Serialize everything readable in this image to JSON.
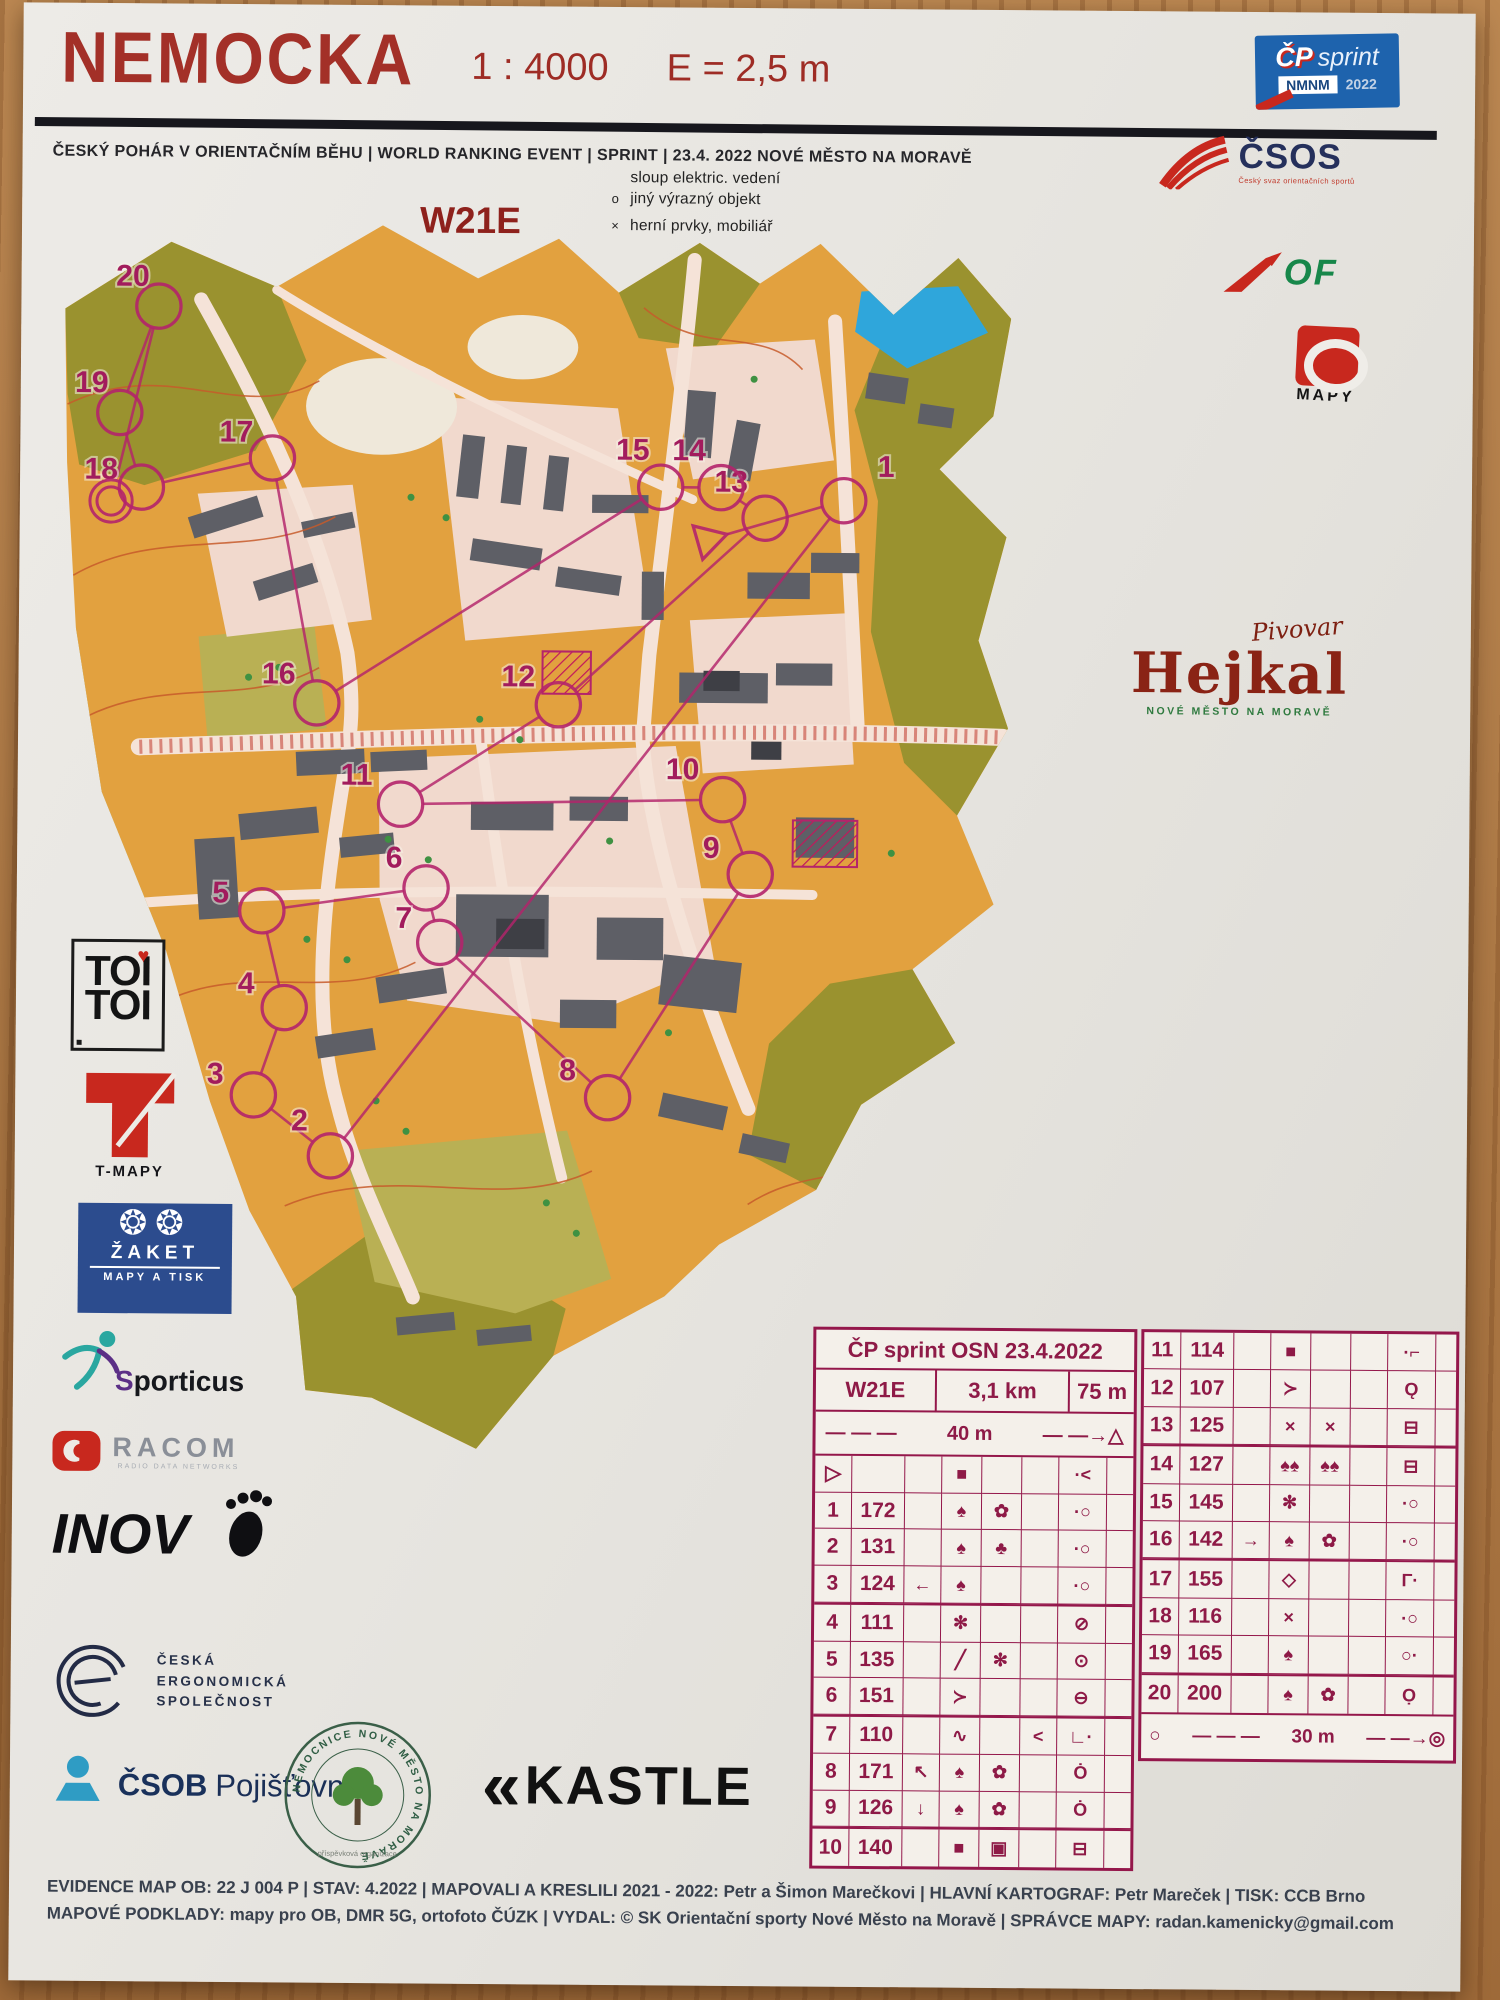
{
  "header": {
    "title": "NEMOCKA",
    "scale": "1 : 4000",
    "equidistance": "E = 2,5 m",
    "info_line": "ČESKÝ POHÁR V ORIENTAČNÍM BĚHU   |   WORLD RANKING EVENT   |   SPRINT   |   23.4. 2022 NOVÉ MĚSTO NA MORAVĚ"
  },
  "badge": {
    "cp": "ČP",
    "sprint": "sprint",
    "nmnm": "NMNM",
    "year": "2022"
  },
  "legend": {
    "items": [
      {
        "symbol": "",
        "label": "sloup elektric. vedení"
      },
      {
        "symbol": "o",
        "label": "jiný výrazný objekt"
      },
      {
        "symbol": "×",
        "label": "herní prvky, mobiliář"
      }
    ]
  },
  "class_label": "W21E",
  "logos": {
    "csos": {
      "name": "ČSOS",
      "tagline": "Český svaz orientačních sportů"
    },
    "iof": {
      "name": "OF"
    },
    "mapy": {
      "name": "MAPY"
    },
    "hejkal": {
      "script": "Pivovar",
      "name": "Hejkal",
      "sub": "NOVÉ MĚSTO NA MORAVĚ"
    },
    "toitoi": {
      "line1": "TOI",
      "line2": "TOI",
      "heart": "♥"
    },
    "tmapy": {
      "label": "T-MAPY"
    },
    "zaket": {
      "suns": "❂❂",
      "name": "ŽAKET",
      "sub": "MAPY A TISK"
    },
    "sporticus": {
      "initial": "S",
      "rest": "porticus"
    },
    "racom": {
      "name": "RACOM",
      "sub": "RADIO DATA NETWORKS"
    },
    "inov": {
      "name": "INOV"
    },
    "ergo": {
      "line1": "ČESKÁ",
      "line2": "ERGONOMICKÁ",
      "line3": "SPOLEČNOST"
    },
    "csob": {
      "name": "ČSOB",
      "sub": "Pojišťovna"
    },
    "hospital": {
      "ring": "NEMOCNICE NOVÉ MĚSTO NA MORAVĚ",
      "sub": "příspěvková organizace"
    },
    "kastle": {
      "chevrons": "«",
      "name": "KASTLE"
    }
  },
  "descriptions": {
    "title": "ČP sprint OSN 23.4.2022",
    "class": "W21E",
    "length": "3,1 km",
    "climb": "75 m",
    "start_distance": "40 m",
    "finish_distance": "30 m",
    "dashes": "— — —",
    "arrow_start": "— —→△",
    "arrow_finish": "— —→◎",
    "finish_pre": "○",
    "left_rows": [
      {
        "c": [
          "▷",
          "",
          "",
          "■",
          "",
          "",
          "·<",
          ""
        ],
        "t": false
      },
      {
        "c": [
          "1",
          "172",
          "",
          "♠",
          "✿",
          "",
          "·○",
          ""
        ],
        "t": false
      },
      {
        "c": [
          "2",
          "131",
          "",
          "♠",
          "♣",
          "",
          "·○",
          ""
        ],
        "t": false
      },
      {
        "c": [
          "3",
          "124",
          "←",
          "♠",
          "",
          "",
          "·○",
          ""
        ],
        "t": false
      },
      {
        "c": [
          "4",
          "111",
          "",
          "✻",
          "",
          "",
          "⊘",
          ""
        ],
        "t": true
      },
      {
        "c": [
          "5",
          "135",
          "",
          "╱",
          "✻",
          "",
          "⊙",
          ""
        ],
        "t": false
      },
      {
        "c": [
          "6",
          "151",
          "",
          "≻",
          "",
          "",
          "⊖",
          ""
        ],
        "t": false
      },
      {
        "c": [
          "7",
          "110",
          "",
          "∿",
          "",
          "<",
          "∟·",
          ""
        ],
        "t": true
      },
      {
        "c": [
          "8",
          "171",
          "↖",
          "♠",
          "✿",
          "",
          "Ȯ",
          ""
        ],
        "t": false
      },
      {
        "c": [
          "9",
          "126",
          "↓",
          "♠",
          "✿",
          "",
          "Ȯ",
          ""
        ],
        "t": false
      },
      {
        "c": [
          "10",
          "140",
          "",
          "■",
          "▣",
          "",
          "⊟",
          ""
        ],
        "t": true
      }
    ],
    "right_rows": [
      {
        "c": [
          "11",
          "114",
          "",
          "■",
          "",
          "",
          "·⌐",
          ""
        ],
        "t": false
      },
      {
        "c": [
          "12",
          "107",
          "",
          "≻",
          "",
          "",
          "Ǫ",
          ""
        ],
        "t": false
      },
      {
        "c": [
          "13",
          "125",
          "",
          "×",
          "×",
          "",
          "⊟",
          ""
        ],
        "t": false
      },
      {
        "c": [
          "14",
          "127",
          "",
          "♠♠",
          "♠♠",
          "",
          "⊟",
          ""
        ],
        "t": true
      },
      {
        "c": [
          "15",
          "145",
          "",
          "✻",
          "",
          "",
          "·○",
          ""
        ],
        "t": false
      },
      {
        "c": [
          "16",
          "142",
          "→",
          "♠",
          "✿",
          "",
          "·○",
          ""
        ],
        "t": false
      },
      {
        "c": [
          "17",
          "155",
          "",
          "◇",
          "",
          "",
          "Γ·",
          ""
        ],
        "t": true
      },
      {
        "c": [
          "18",
          "116",
          "",
          "×",
          "",
          "",
          "·○",
          ""
        ],
        "t": false
      },
      {
        "c": [
          "19",
          "165",
          "",
          "♠",
          "",
          "",
          "○·",
          ""
        ],
        "t": false
      },
      {
        "c": [
          "20",
          "200",
          "",
          "♠",
          "✿",
          "",
          "Ọ",
          ""
        ],
        "t": true
      }
    ]
  },
  "course": {
    "color": "#B4246B",
    "label_color": "#A21C5D",
    "start": {
      "x": 655,
      "y": 340
    },
    "finish": {
      "x": 62,
      "y": 306
    },
    "controls": [
      {
        "n": "1",
        "cx": 790,
        "cy": 300,
        "lx": 832,
        "ly": 276
      },
      {
        "n": "2",
        "cx": 285,
        "cy": 955,
        "lx": 254,
        "ly": 930
      },
      {
        "n": "3",
        "cx": 208,
        "cy": 895,
        "lx": 170,
        "ly": 884
      },
      {
        "n": "4",
        "cx": 238,
        "cy": 808,
        "lx": 200,
        "ly": 794
      },
      {
        "n": "5",
        "cx": 215,
        "cy": 712,
        "lx": 174,
        "ly": 704
      },
      {
        "n": "6",
        "cx": 378,
        "cy": 688,
        "lx": 346,
        "ly": 668
      },
      {
        "n": "7",
        "cx": 392,
        "cy": 742,
        "lx": 356,
        "ly": 728
      },
      {
        "n": "8",
        "cx": 560,
        "cy": 895,
        "lx": 520,
        "ly": 878
      },
      {
        "n": "9",
        "cx": 700,
        "cy": 672,
        "lx": 661,
        "ly": 656
      },
      {
        "n": "10",
        "cx": 672,
        "cy": 598,
        "lx": 632,
        "ly": 578
      },
      {
        "n": "11",
        "cx": 352,
        "cy": 605,
        "lx": 308,
        "ly": 586
      },
      {
        "n": "12",
        "cx": 508,
        "cy": 505,
        "lx": 468,
        "ly": 487
      },
      {
        "n": "13",
        "cx": 712,
        "cy": 318,
        "lx": 678,
        "ly": 292
      },
      {
        "n": "14",
        "cx": 668,
        "cy": 288,
        "lx": 636,
        "ly": 261
      },
      {
        "n": "15",
        "cx": 608,
        "cy": 288,
        "lx": 580,
        "ly": 261
      },
      {
        "n": "16",
        "cx": 268,
        "cy": 505,
        "lx": 230,
        "ly": 486
      },
      {
        "n": "17",
        "cx": 222,
        "cy": 262,
        "lx": 186,
        "ly": 246
      },
      {
        "n": "18",
        "cx": 92,
        "cy": 292,
        "lx": 52,
        "ly": 284
      },
      {
        "n": "19",
        "cx": 70,
        "cy": 218,
        "lx": 42,
        "ly": 198
      },
      {
        "n": "20",
        "cx": 108,
        "cy": 112,
        "lx": 82,
        "ly": 92
      }
    ]
  },
  "footer": {
    "line1": "EVIDENCE MAP OB: 22 J 004 P | STAV: 4.2022 | MAPOVALI A KRESLILI 2021 - 2022: Petr a Šimon Marečkovi | HLAVNÍ KARTOGRAF: Petr Mareček | TISK: CCB Brno",
    "line2": "MAPOVÉ PODKLADY: mapy pro OB, DMR 5G, ortofoto ČÚZK | VYDAL: © SK Orientační sporty Nové Město na Moravě | SPRÁVCE MAPY: radan.kamenicky@gmail.com"
  }
}
